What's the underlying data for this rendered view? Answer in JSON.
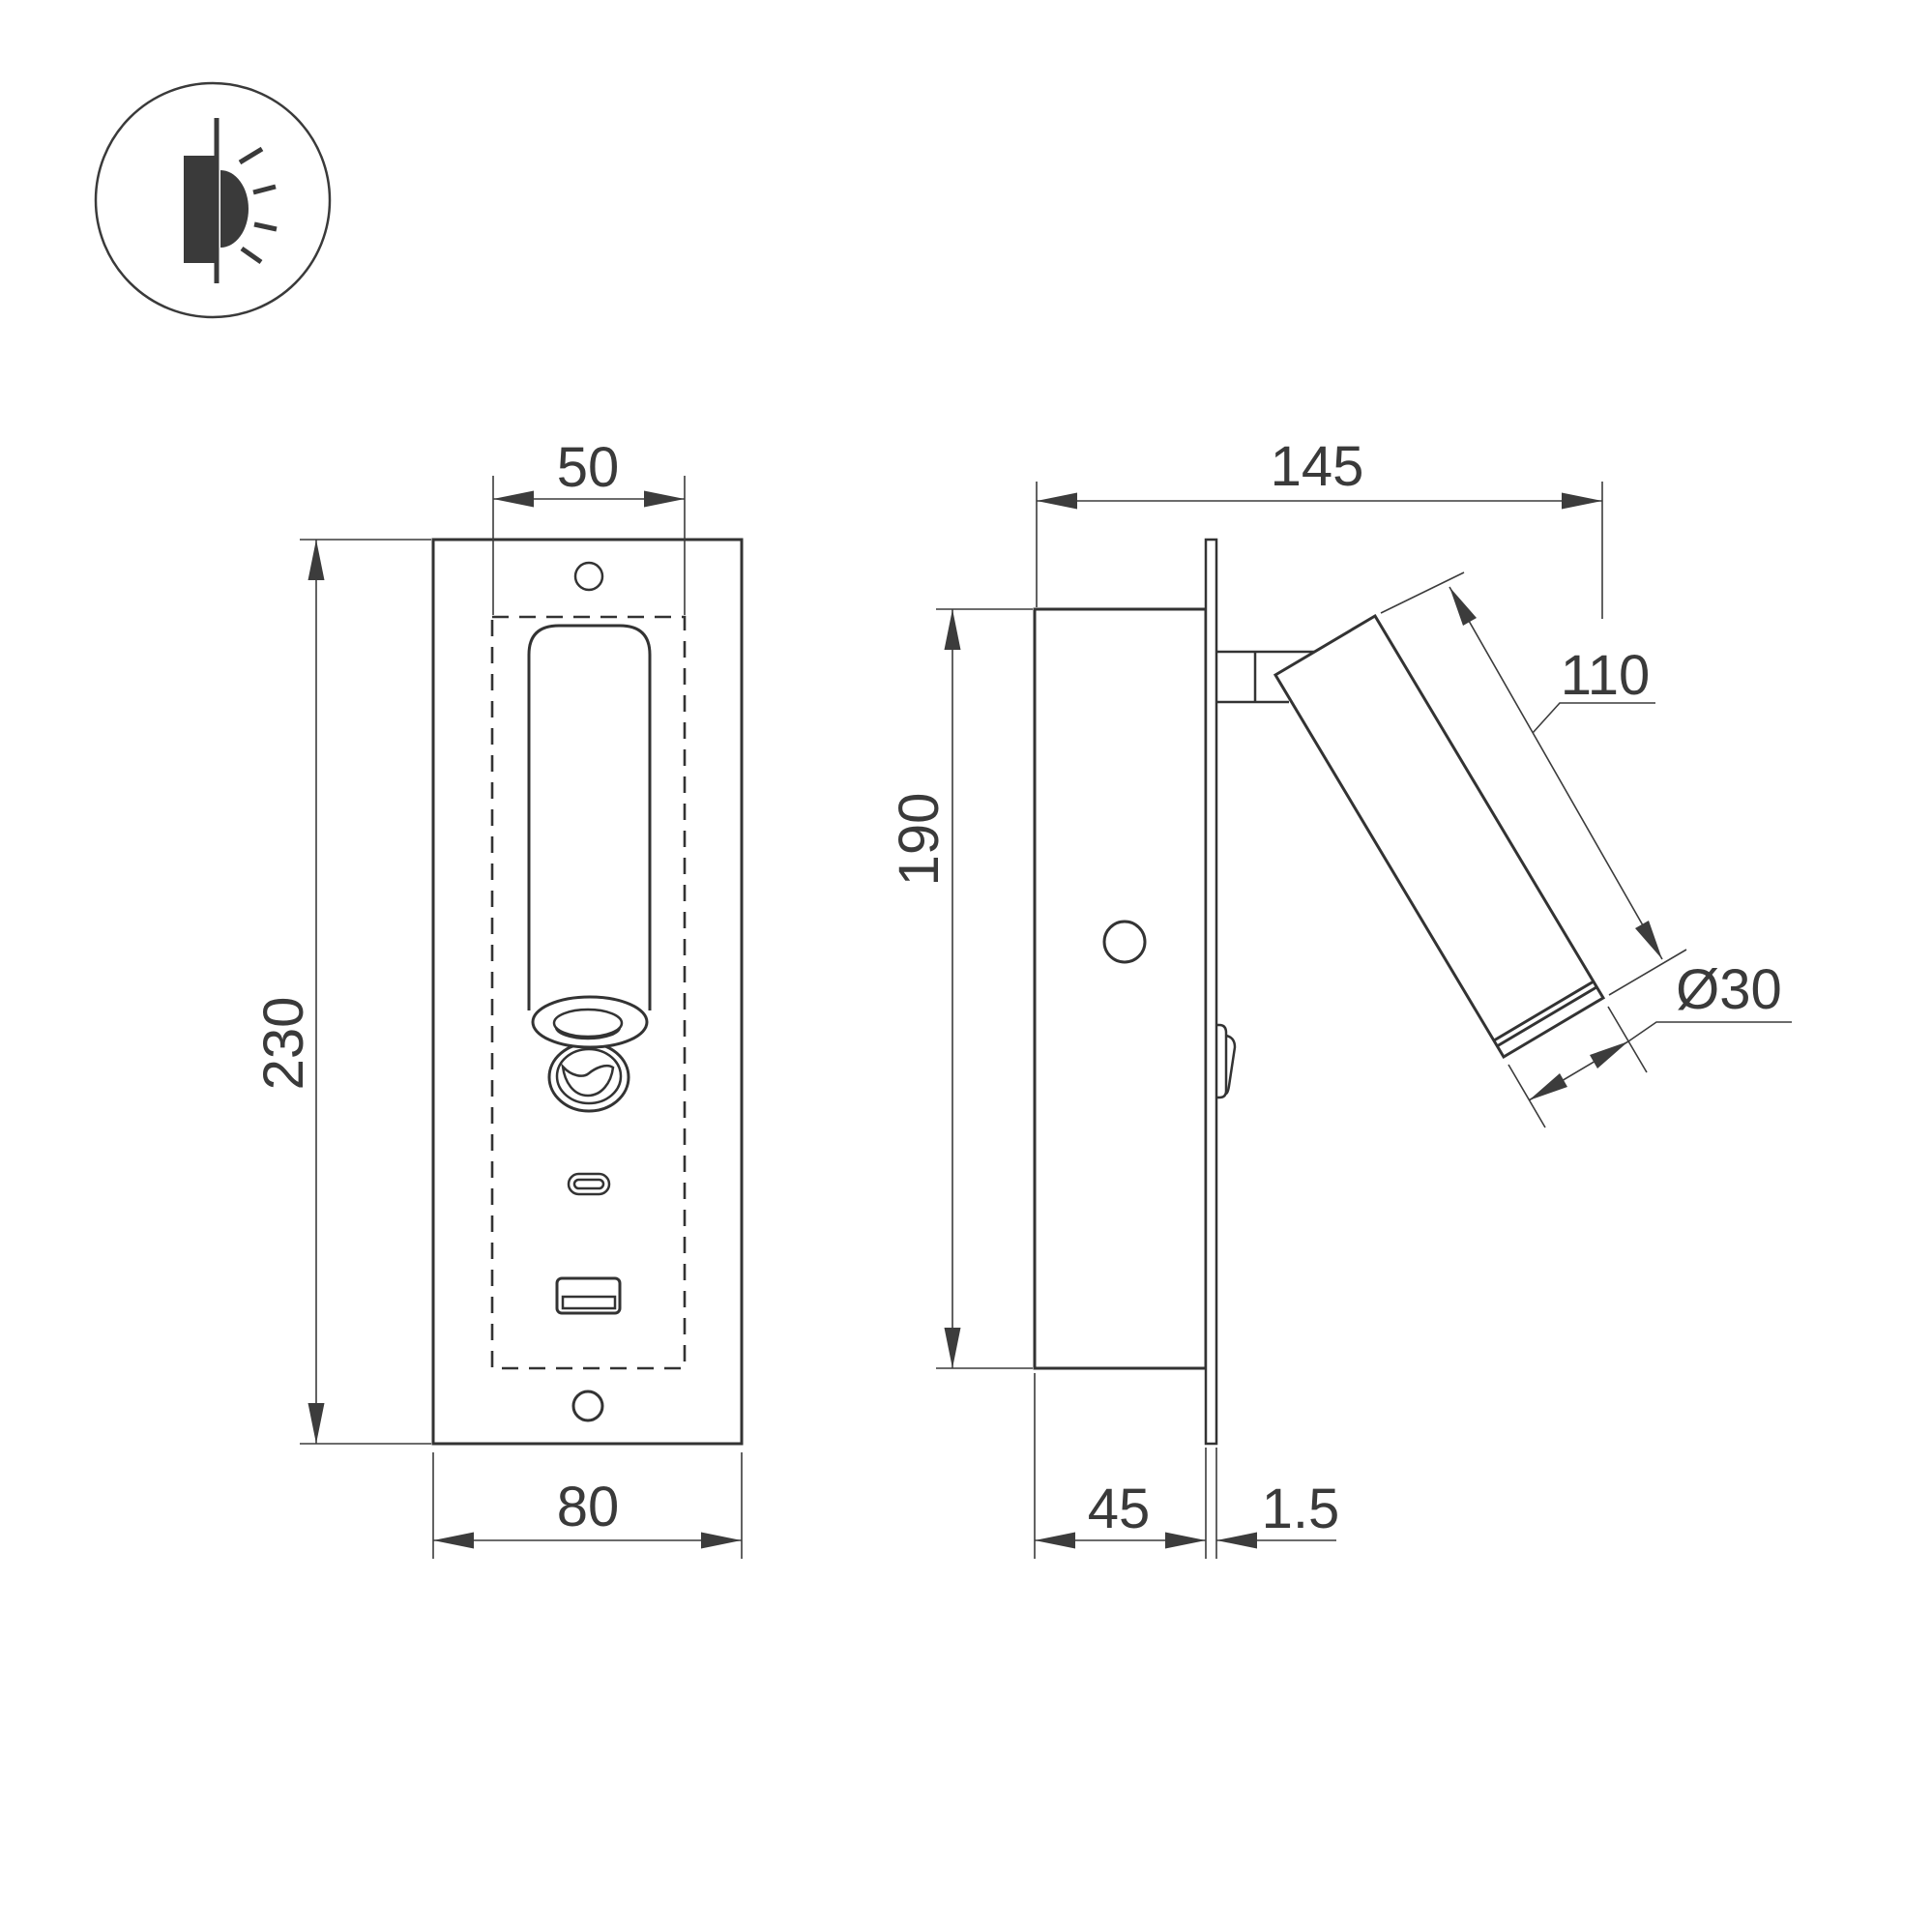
{
  "background": "#ffffff",
  "line_color": "#333333",
  "icon": {
    "name": "recessed-wall-light-icon"
  },
  "front_view": {
    "title": "front view",
    "dimensions": {
      "recess_width": "50",
      "plate_height": "230",
      "plate_width": "80"
    }
  },
  "side_view": {
    "title": "side view",
    "dimensions": {
      "total_depth": "145",
      "body_height": "190",
      "spot_length": "110",
      "spot_diameter": "Ø30",
      "recess_depth": "45",
      "plate_thickness": "1.5"
    }
  }
}
